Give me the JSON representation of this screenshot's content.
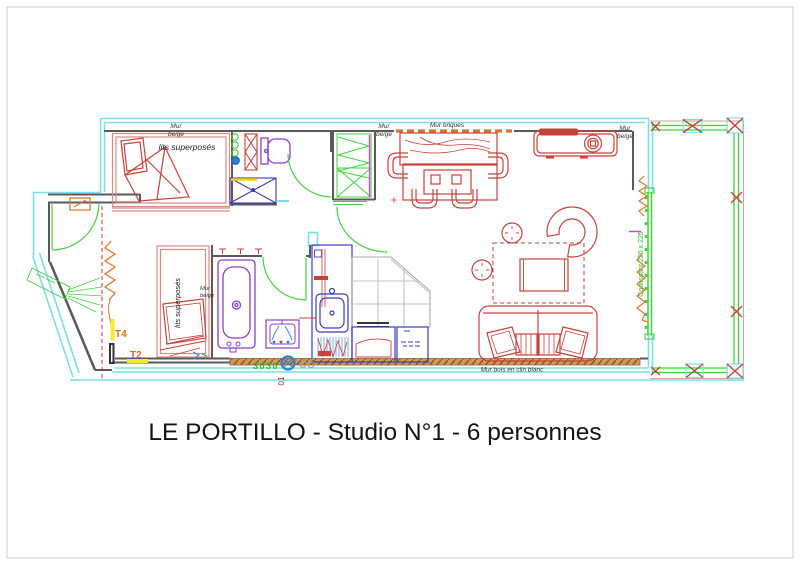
{
  "title": "LE PORTILLO - Studio N°1 - 6 personnes",
  "plan": {
    "walls": {
      "beige_line1": "Mur",
      "beige_line2": "beige",
      "briques": "Mur briques",
      "bois": "Mur bois en clin blanc"
    },
    "furniture": {
      "bunk_beds": "lits superposés"
    },
    "openings": {
      "sliding_door": "Coulissant 220 x 225"
    },
    "annotations": {
      "t4": "T4",
      "t2": "T2",
      "code_green": "3030",
      "code_red": "01"
    },
    "colors": {
      "outer_wall_cyan": "#7adfe9",
      "inner_wall_gray": "#5a5a5a",
      "furniture_red": "#c7423a",
      "joinery_green": "#3fd23f",
      "sanitary_purple": "#8b3fc6",
      "kitchen_blue": "#3b3bc0",
      "accent_orange": "#e0762c",
      "wood_brown": "#cf9a5a",
      "highlight_yellow": "#ffe92a"
    }
  }
}
